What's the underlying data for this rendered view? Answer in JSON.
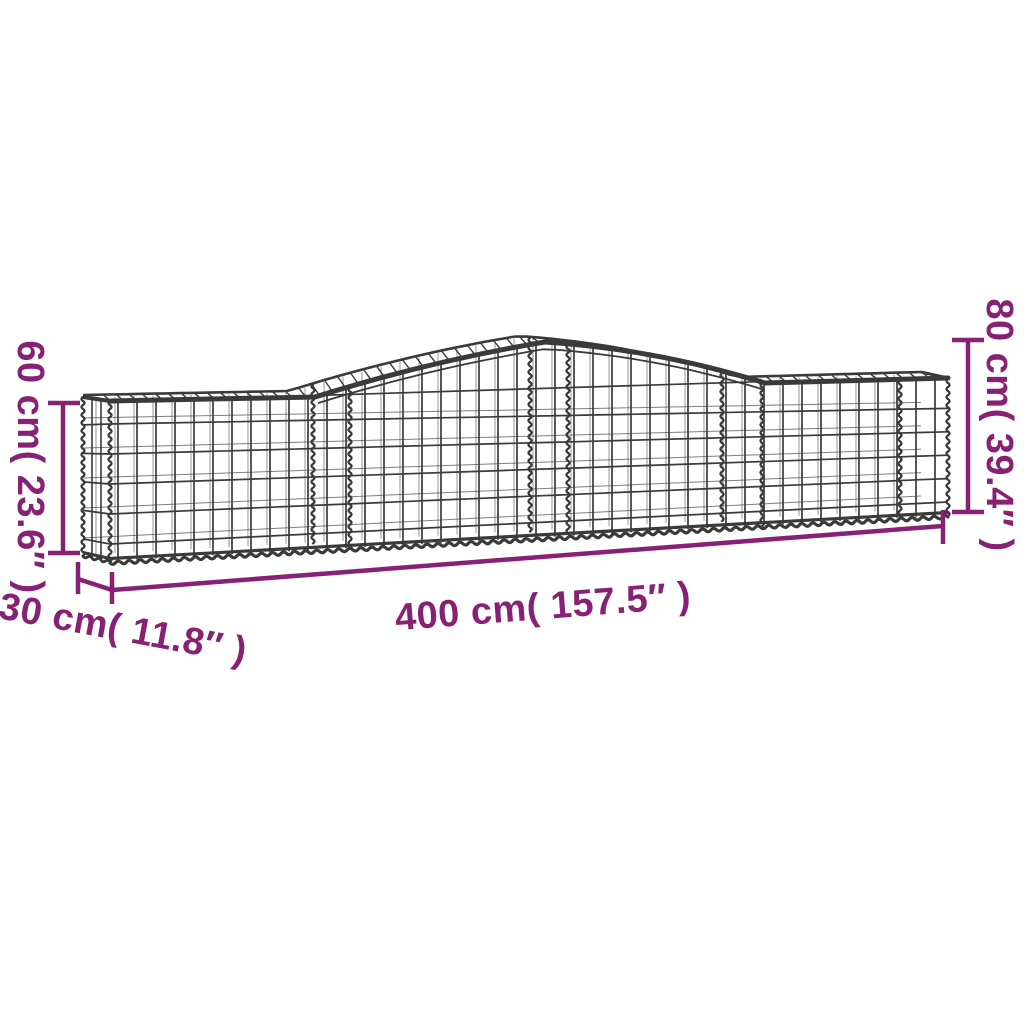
{
  "colors": {
    "background": "#ffffff",
    "dimension": "#872173",
    "mesh": "#3a3a3a"
  },
  "labels": {
    "height_left": "60 cm( 23.6″ )",
    "height_right": "80 cm( 39.4″ )",
    "depth": "30 cm( 11.8″ )",
    "length": "400 cm( 157.5″ )"
  },
  "measurements": {
    "height_left": {
      "cm": 60,
      "inches": 23.6
    },
    "height_right": {
      "cm": 80,
      "inches": 39.4
    },
    "depth": {
      "cm": 30,
      "inches": 11.8
    },
    "length": {
      "cm": 400,
      "inches": 157.5
    }
  }
}
